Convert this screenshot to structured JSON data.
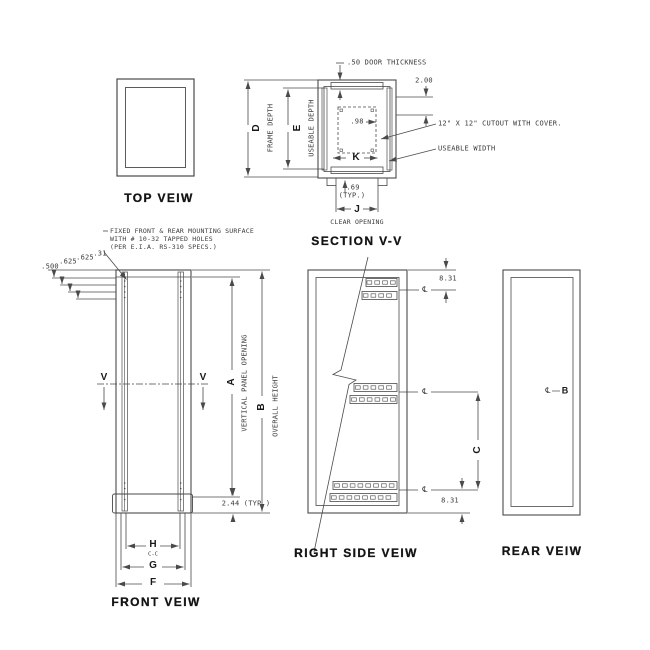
{
  "colors": {
    "line": "#4a4a4a",
    "text": "#3b3b3b",
    "background": "#ffffff"
  },
  "top_view": {
    "title": "TOP VEIW"
  },
  "depth_dims": {
    "d_letter": "D",
    "d_label": "FRAME DEPTH",
    "e_letter": "E",
    "e_label": "USEABLE DEPTH"
  },
  "section_view": {
    "title": "SECTION V-V",
    "door_thickness_note": ".50 DOOR THICKNESS",
    "dim_200": "2.00",
    "dim_98": ".98",
    "cutout_note": "12\" X 12\" CUTOUT WITH COVER.",
    "useable_width_label": "USEABLE WIDTH",
    "k_letter": "K",
    "dim_69": ".69",
    "typ_69": "(TYP.)",
    "j_letter": "J",
    "clear_opening_label": "CLEAR OPENING"
  },
  "front_view": {
    "title": "FRONT VEIW",
    "note_line1": "FIXED FRONT & REAR MOUNTING SURFACE",
    "note_line2": "WITH # 10-32 TAPPED HOLES",
    "note_line3": "(PER E.I.A. RS-310 SPECS.)",
    "dim_500": ".500",
    "dim_625a": ".625",
    "dim_625b": ".625",
    "dim_31": ".31",
    "section_marker": "V",
    "a_letter": "A",
    "a_label": "VERTICAL PANEL OPENING",
    "b_letter": "B",
    "b_label": "OVERALL HEIGHT",
    "dim_244": "2.44 (TYP.)",
    "h_letter": "H",
    "cc_label": "C-C",
    "g_letter": "G",
    "f_letter": "F"
  },
  "right_side_view": {
    "title": "RIGHT SIDE VEIW",
    "dim_top": "8.31",
    "dim_bottom": "8.31",
    "c_letter": "C",
    "centerline_symbol": "℄"
  },
  "rear_view": {
    "title": "REAR VEIW",
    "centerline_symbol": "℄",
    "b_letter": "B"
  }
}
